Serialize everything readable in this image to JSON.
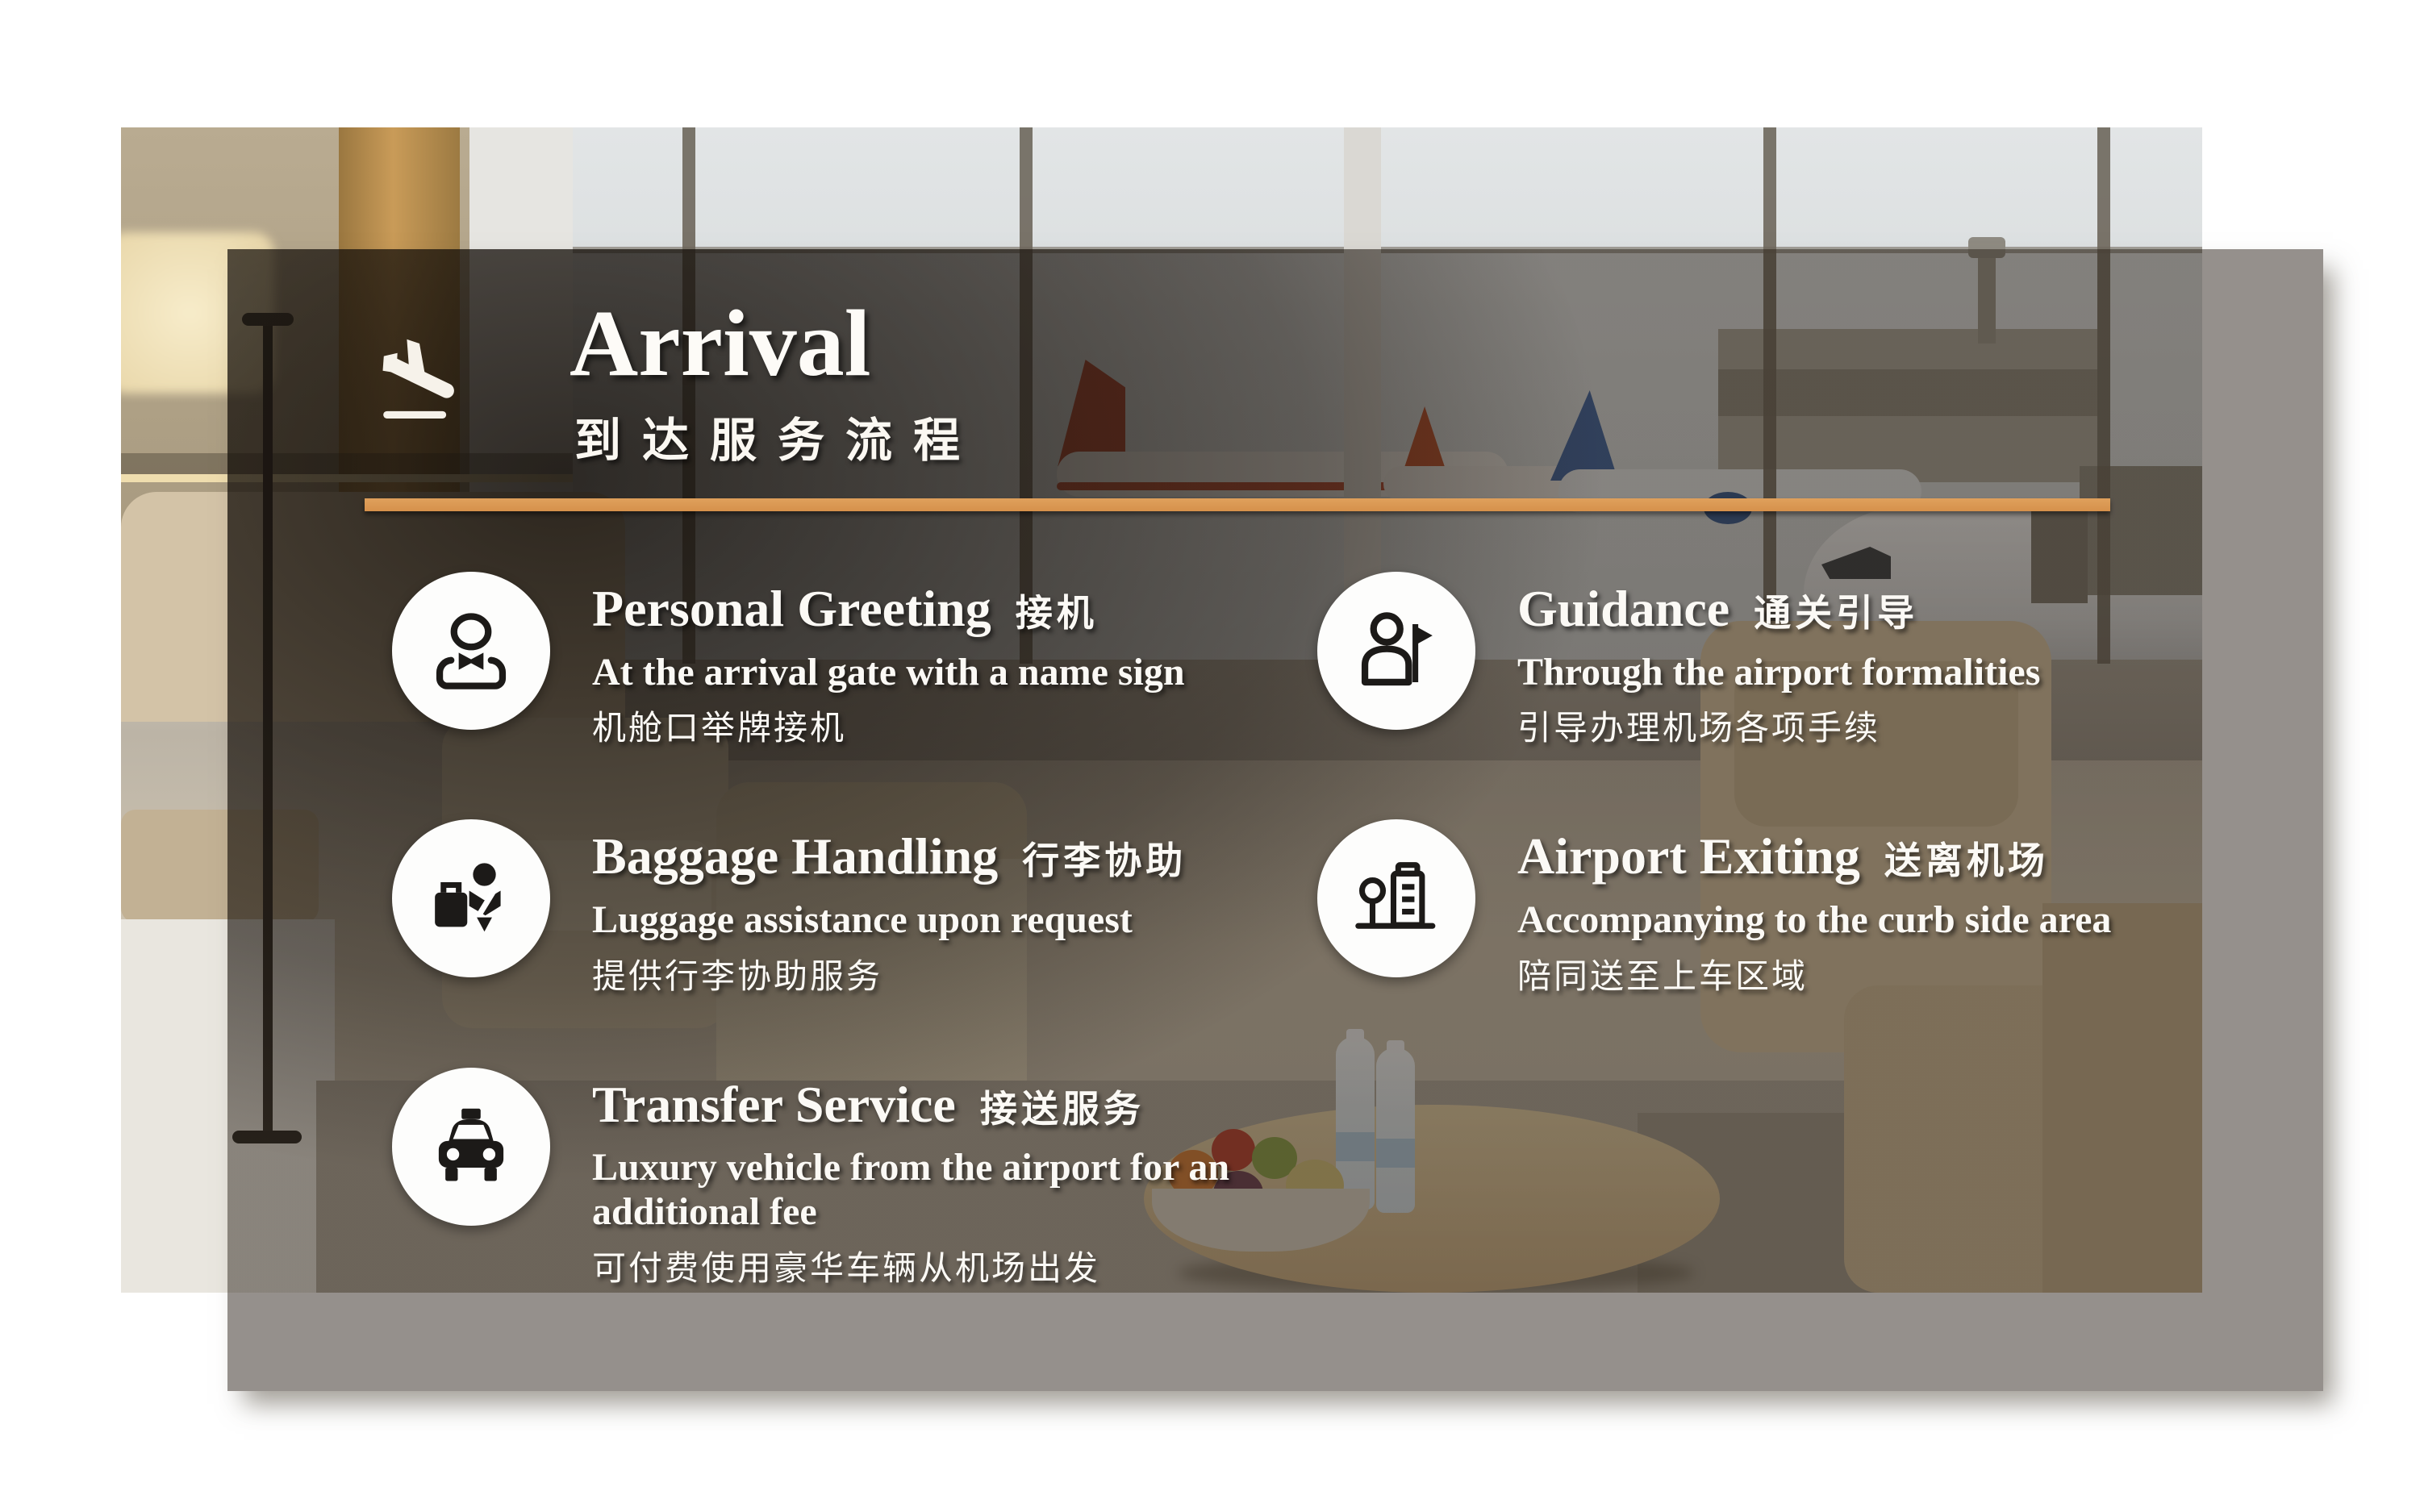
{
  "slide": {
    "title": "Arrival",
    "subtitle_zh": "到达服务流程",
    "accent_color": "#dfa05c"
  },
  "services": [
    {
      "title": "Personal Greeting",
      "title_zh": "接机",
      "desc": "At the arrival gate with a name sign",
      "desc_zh": "机舱口举牌接机",
      "icon": "concierge-icon"
    },
    {
      "title": "Guidance",
      "title_zh": "通关引导",
      "desc": "Through the airport formalities",
      "desc_zh": "引导办理机场各项手续",
      "icon": "guide-flag-icon"
    },
    {
      "title": "Baggage Handling",
      "title_zh": "行李协助",
      "desc": "Luggage assistance upon request",
      "desc_zh": "提供行李协助服务",
      "icon": "baggage-icon"
    },
    {
      "title": "Airport Exiting",
      "title_zh": "送离机场",
      "desc": "Accompanying to the curb side area",
      "desc_zh": "陪同送至上车区域",
      "icon": "city-icon"
    },
    {
      "title": "Transfer Service",
      "title_zh": "接送服务",
      "desc": "Luxury vehicle from the airport for an additional fee",
      "desc_zh": "可付费使用豪华车辆从机场出发",
      "icon": "taxi-icon"
    }
  ]
}
